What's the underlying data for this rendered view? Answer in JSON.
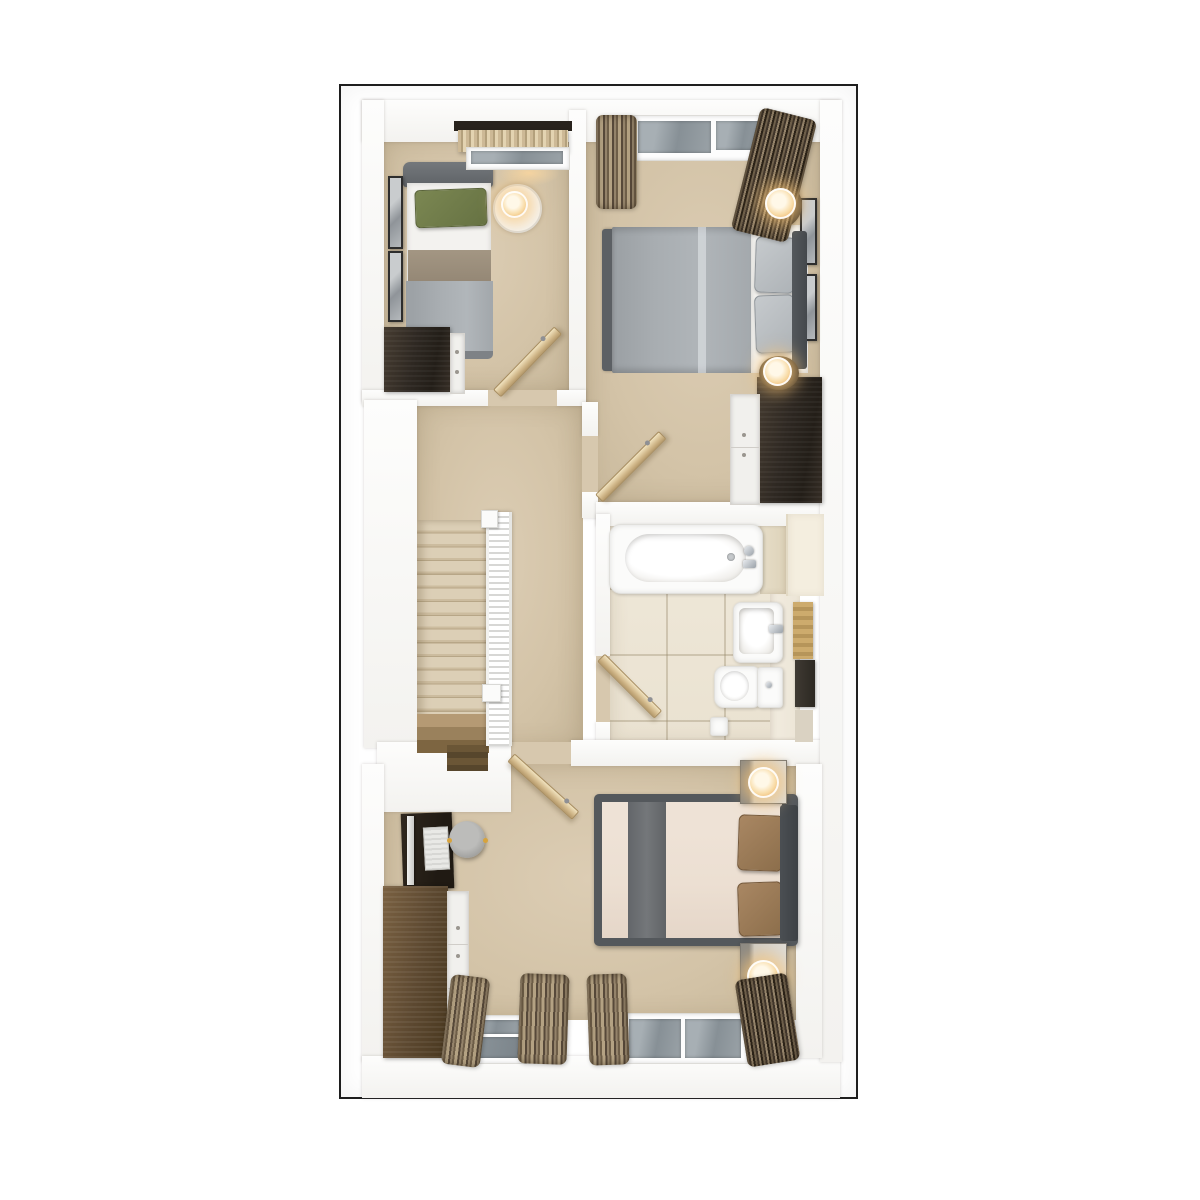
{
  "scene": {
    "type": "3d-floorplan-top-down-render",
    "title": "",
    "visible_text": [],
    "rooms": [
      {
        "name": "bedroom-top-left",
        "furniture": [
          "single-bed",
          "green-pillow",
          "white-sheet",
          "taupe-runner",
          "grey-duvet",
          "headboard",
          "bedside-saucer-table",
          "table-lamp",
          "two-wall-art-frames",
          "chest-of-drawers",
          "window",
          "valance",
          "curtain-rail",
          "door-leaf"
        ]
      },
      {
        "name": "bedroom-top-right",
        "furniture": [
          "double-bed",
          "grey-duvet",
          "two-grey-pillows",
          "headboard",
          "white-platform",
          "two-round-side-tables",
          "two-table-lamps",
          "two-wall-art-frames",
          "wardrobe-dresser",
          "window-two-panes",
          "two-curtain-bundles",
          "door-leaf"
        ]
      },
      {
        "name": "landing",
        "furniture": [
          "staircase",
          "carpeted-treads",
          "banister-railing",
          "newel-posts",
          "stairwell-void"
        ]
      },
      {
        "name": "bathroom",
        "furniture": [
          "bathtub",
          "bath-taps",
          "wash-basin",
          "basin-tap",
          "toilet",
          "cistern",
          "toilet-roll-holder",
          "tan-shelf-unit",
          "dark-cabinet",
          "tiled-floor",
          "door-leaf"
        ]
      },
      {
        "name": "bedroom-bottom",
        "furniture": [
          "double-bed",
          "cream-bedding",
          "grey-bed-runner",
          "two-brown-pillows",
          "headboard",
          "two-nightstands",
          "two-table-lamps",
          "desk",
          "monitor",
          "keyboard",
          "grey-stool",
          "chest-of-drawers",
          "two-windows",
          "four-curtain-bundles",
          "door-leaf"
        ]
      }
    ]
  },
  "palette": {
    "frame_border": "#1e1e1e",
    "wall_white": "#f7f6f4",
    "carpet_beige": "#d3c3a7",
    "bath_tile": "#ece4d4",
    "wood_dark": "#2e2822",
    "wood_door": "#d4bb8e",
    "duvet_grey": "#a8adb1",
    "pillow_green": "#6f7b49",
    "runner_taupe": "#9a8d7b",
    "bedding_cream": "#ecdfd2",
    "pillow_brown": "#9c7c57",
    "runner_grey": "#6d7073",
    "curtain_brown": "#6e5e48",
    "lamp_glow": "#f8dba6",
    "glass_grey": "#879096",
    "tan_shelf": "#c7a568"
  }
}
